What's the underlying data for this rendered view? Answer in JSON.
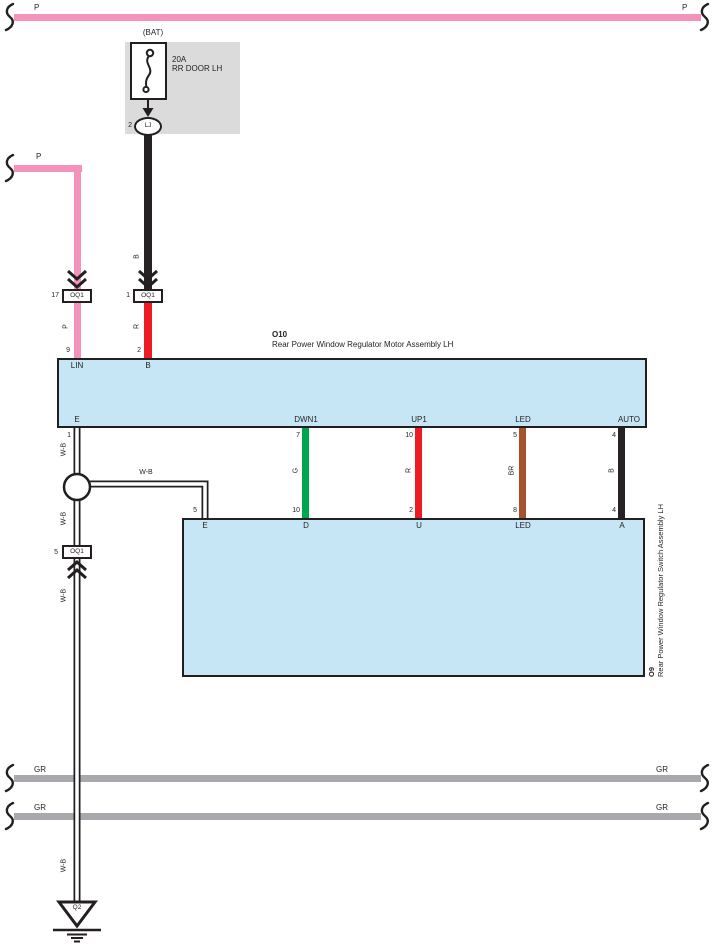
{
  "colors": {
    "pink": "#F492BB",
    "red": "#EC1B24",
    "green": "#00A64F",
    "brown": "#A6522D",
    "wire_black": "#262223",
    "gray_bus": "#A7A9AC",
    "component_fill": "#C7E6F5",
    "fuse_block_fill": "#DBDBDB",
    "line": "#231F20"
  },
  "top_bus": {
    "left_label": "P",
    "right_label": "P"
  },
  "fuse_block": {
    "source": "(BAT)",
    "rating": "20A",
    "name": "RR DOOR LH",
    "out_pin": "2",
    "out_connector": "LJ"
  },
  "battery_feed": {
    "code": "B",
    "connector_pin": "1",
    "connector_name": "OQ1",
    "code_below": "R",
    "motor_pin": "2",
    "motor_pin_label": "B"
  },
  "lin_feed": {
    "bus_label": "P",
    "connector_pin": "17",
    "connector_name": "OQ1",
    "code_below": "P",
    "motor_pin": "9",
    "motor_pin_label": "LIN"
  },
  "motor": {
    "id": "O10",
    "name": "Rear Power Window Regulator Motor Assembly LH",
    "pins": {
      "e_label": "E",
      "e_pin": "1",
      "dwn1_label": "DWN1",
      "dwn1_pin": "7",
      "up1_label": "UP1",
      "up1_pin": "10",
      "led_label": "LED",
      "led_pin": "5",
      "auto_label": "AUTO",
      "auto_pin": "4"
    }
  },
  "links": {
    "down": {
      "code": "G",
      "switch_pin": "10",
      "switch_label": "D"
    },
    "up": {
      "code": "R",
      "switch_pin": "2",
      "switch_label": "U"
    },
    "led": {
      "code": "BR",
      "switch_pin": "8",
      "switch_label": "LED"
    },
    "auto": {
      "code": "B",
      "switch_pin": "4",
      "switch_label": "A"
    }
  },
  "switch": {
    "id": "O9",
    "name": "Rear Power Window Regulator Switch Assembly LH",
    "e_pin": "5",
    "e_label": "E"
  },
  "ground_run": {
    "code1": "W-B",
    "code_h": "W-B",
    "code2": "W-B",
    "code3": "W-B",
    "code4": "W-B",
    "connector_pin": "5",
    "connector_name": "OQ1",
    "ground_id": "Q2"
  },
  "gr_bus1": {
    "left_label": "GR",
    "right_label": "GR"
  },
  "gr_bus2": {
    "left_label": "GR",
    "right_label": "GR"
  }
}
